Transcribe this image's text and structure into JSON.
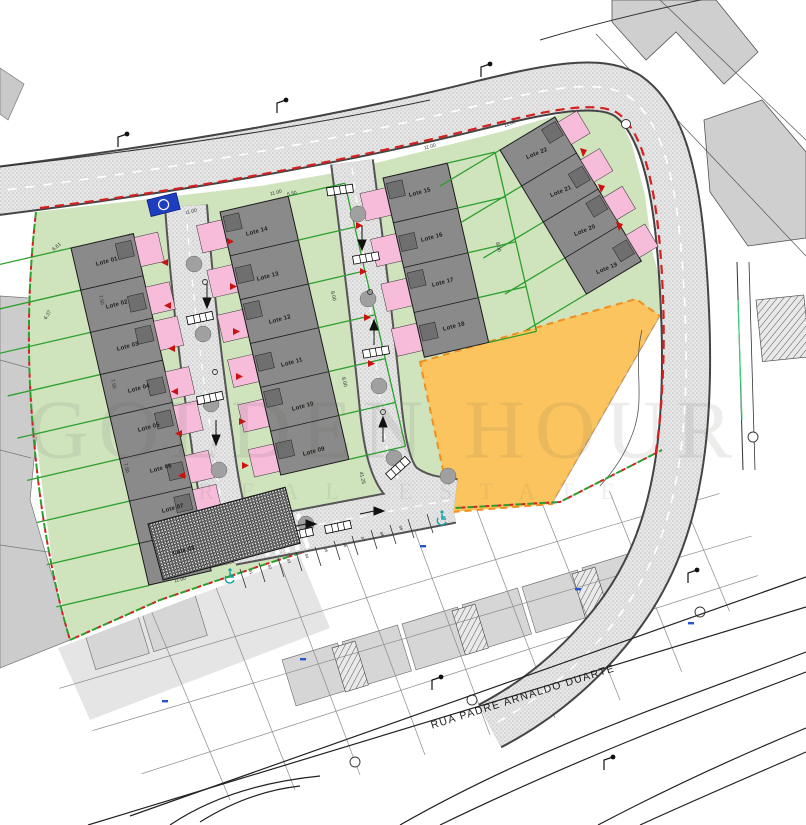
{
  "document": {
    "type": "allotment site plan",
    "street_name": "RUA PADRE ARNALDO DUARTE"
  },
  "watermark": {
    "line1": "GOLDEN HOUR",
    "line2": "REAL ESTATE"
  },
  "lots": [
    "Lote 01",
    "Lote 02",
    "Lote 03",
    "Lote 04",
    "Lote 05",
    "Lote 06",
    "Lote 07",
    "Lote 08",
    "Lote 09",
    "Lote 10",
    "Lote 11",
    "Lote 12",
    "Lote 13",
    "Lote 14",
    "Lote 15",
    "Lote 16",
    "Lote 17",
    "Lote 18",
    "Lote 19",
    "Lote 20",
    "Lote 21",
    "Lote 22"
  ],
  "parking_spaces": [
    "01",
    "02",
    "03",
    "04",
    "05",
    "06",
    "07",
    "08",
    "09"
  ],
  "dims": [
    "11.00",
    "7.50",
    "8.00",
    "6.61",
    "6.37",
    "5.50",
    "41.25"
  ],
  "colors": {
    "site_green": "#cfe3bd",
    "garden_line_green": "#2ca02c",
    "building_gray": "#8a8a8a",
    "roof_gray": "#6f6f6f",
    "pink": "#f7bcd9",
    "orange_lot": "#fcc45f",
    "orange_border": "#ef8f1f",
    "road_fill": "#e6e6e6",
    "boundary_red": "#d42020",
    "accent_blue": "#1d3fbf",
    "handicap_teal": "#12a3a3",
    "existing_gray": "#cfcfcf"
  }
}
